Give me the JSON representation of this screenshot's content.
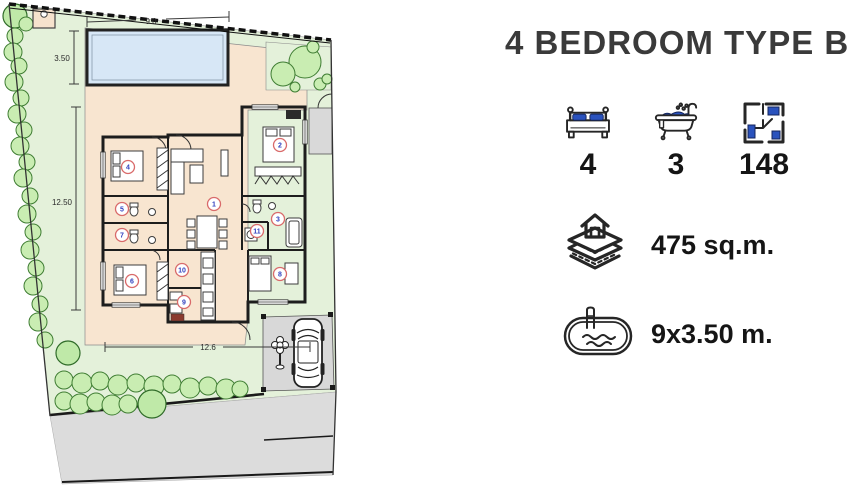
{
  "header": {
    "title": "4 BEDROOM TYPE B"
  },
  "stats": {
    "bedrooms": {
      "icon": "bed-icon",
      "value": "4"
    },
    "bathrooms": {
      "icon": "bathtub-icon",
      "value": "3"
    },
    "built_area": {
      "icon": "floorplan-icon",
      "value": "148"
    },
    "land_area": {
      "icon": "land-plot-icon",
      "value": "475 sq.m."
    },
    "pool_size": {
      "icon": "pool-icon",
      "value": "9x3.50 m."
    }
  },
  "plan": {
    "dimensions": {
      "pool_width": "9.0",
      "pool_depth": "3.50",
      "garden_depth": "12.50",
      "house_width": "12.6"
    },
    "rooms": [
      "1",
      "2",
      "3",
      "4",
      "5",
      "6",
      "7",
      "8",
      "9",
      "10",
      "11"
    ]
  },
  "colors": {
    "accent_blue": "#2a52bd",
    "lawn_green": "#e4f1da",
    "hedge_green": "#c9edb2",
    "deck_peach": "#f8e5d0",
    "pool_blue": "#d7e7f6",
    "road_gray": "#dcdcdc",
    "wall_dark": "#1d1d1d",
    "marker_red": "#d96a6a",
    "room_number_blue": "#2f3fbe",
    "title_gray": "#3a3a3a"
  }
}
